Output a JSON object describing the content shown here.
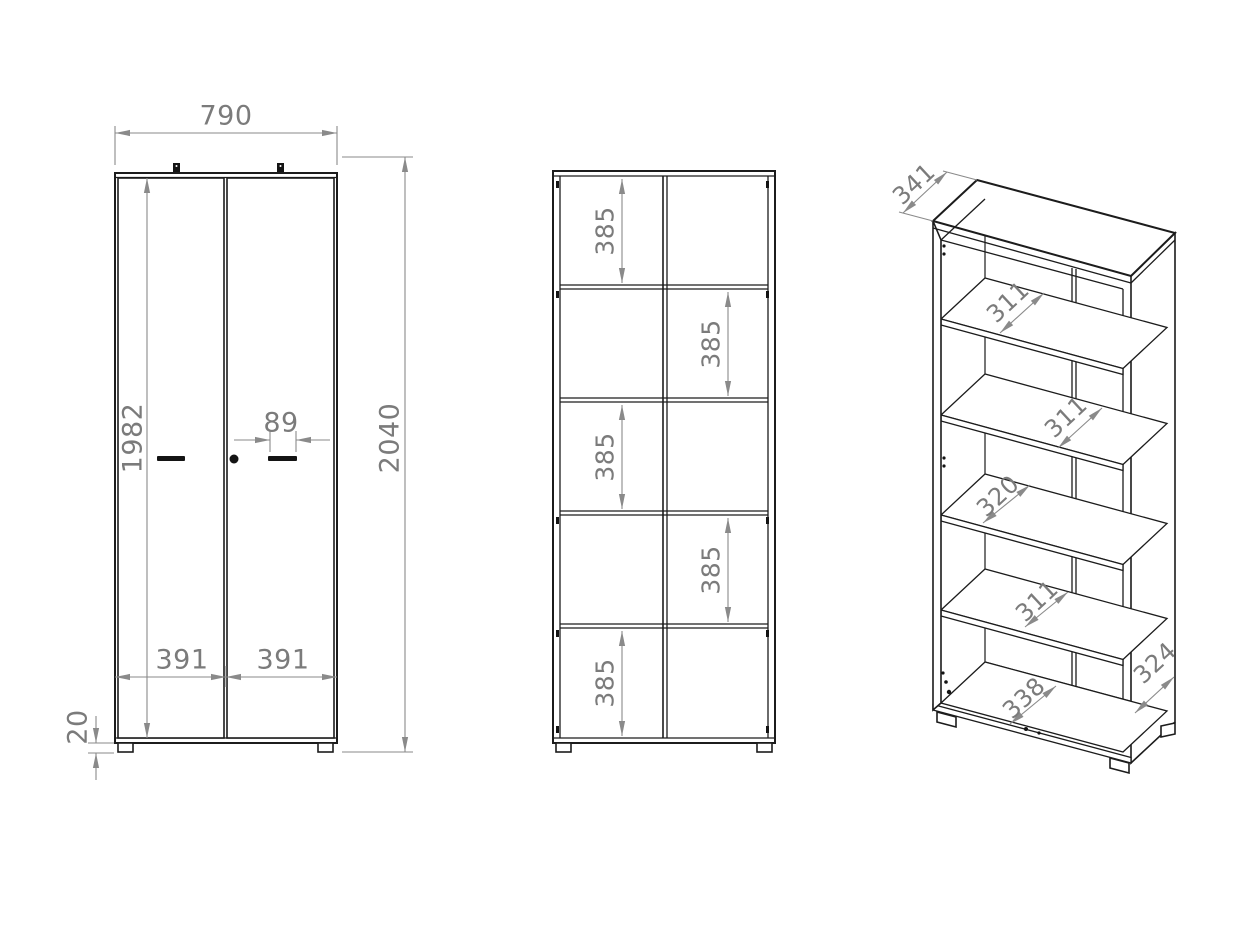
{
  "palette": {
    "background": "#ffffff",
    "drawing_line": "#1c1c1c",
    "dimension_line": "#8a8a8a",
    "dimension_text": "#7b7b7b"
  },
  "views": {
    "front": {
      "width_mm": "790",
      "total_height_mm": "2040",
      "door_height_mm": "1982",
      "handle_width_mm": "89",
      "left_door_width_mm": "391",
      "right_door_width_mm": "391",
      "plinth_height_mm": "20"
    },
    "open": {
      "compartments": [
        {
          "label": "385"
        },
        {
          "label": "385"
        },
        {
          "label": "385"
        },
        {
          "label": "385"
        },
        {
          "label": "385"
        }
      ]
    },
    "perspective": {
      "top_depth_mm": "341",
      "shelf_clearances": [
        {
          "label": "311"
        },
        {
          "label": "311"
        },
        {
          "label": "320"
        },
        {
          "label": "311"
        }
      ],
      "bottom_depth_mm": "338",
      "side_depth_mm": "324"
    }
  }
}
